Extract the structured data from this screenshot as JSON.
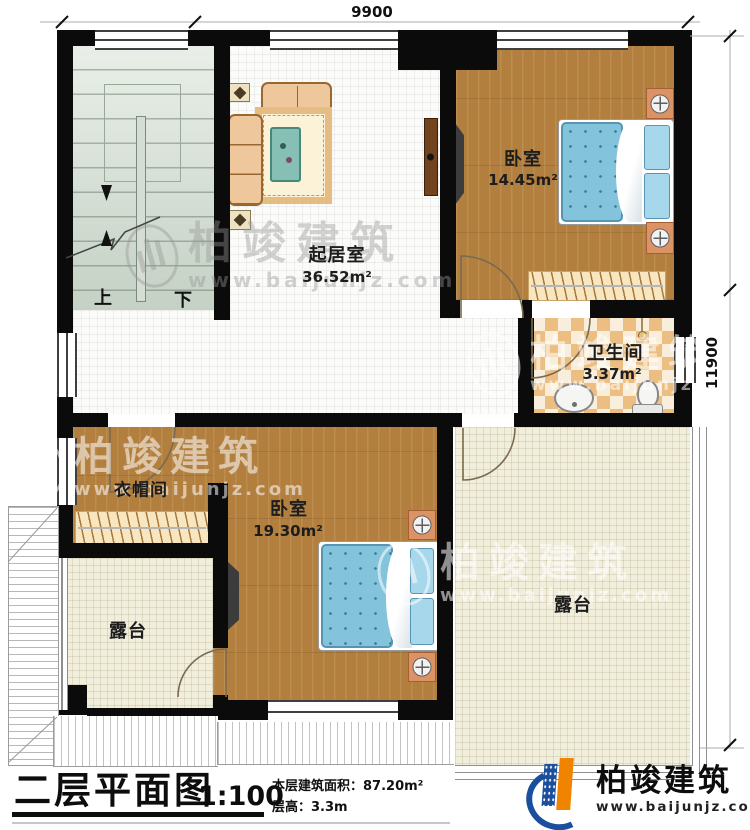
{
  "dimensions": {
    "top": "9900",
    "right": "11900"
  },
  "stairs": {
    "up": "上",
    "down": "下"
  },
  "rooms": {
    "living": {
      "name": "起居室",
      "area": "36.52m²"
    },
    "bedroom1": {
      "name": "卧室",
      "area": "14.45m²"
    },
    "bathroom": {
      "name": "卫生间",
      "area": "3.37m²"
    },
    "cloakroom": {
      "name": "衣帽间"
    },
    "bedroom2": {
      "name": "卧室",
      "area": "19.30m²"
    },
    "terrace1": {
      "name": "露台"
    },
    "terrace2": {
      "name": "露台"
    }
  },
  "watermark": {
    "title": "柏竣建筑",
    "url": "www.baijunjz.com"
  },
  "title_block": {
    "title": "二层平面图",
    "scale": "1:100",
    "area_line": "本层建筑面积：87.20m²",
    "floor_height_line": "层高：3.3m"
  },
  "brand": {
    "name": "柏竣建筑",
    "url": "www.baijunjz.com"
  }
}
